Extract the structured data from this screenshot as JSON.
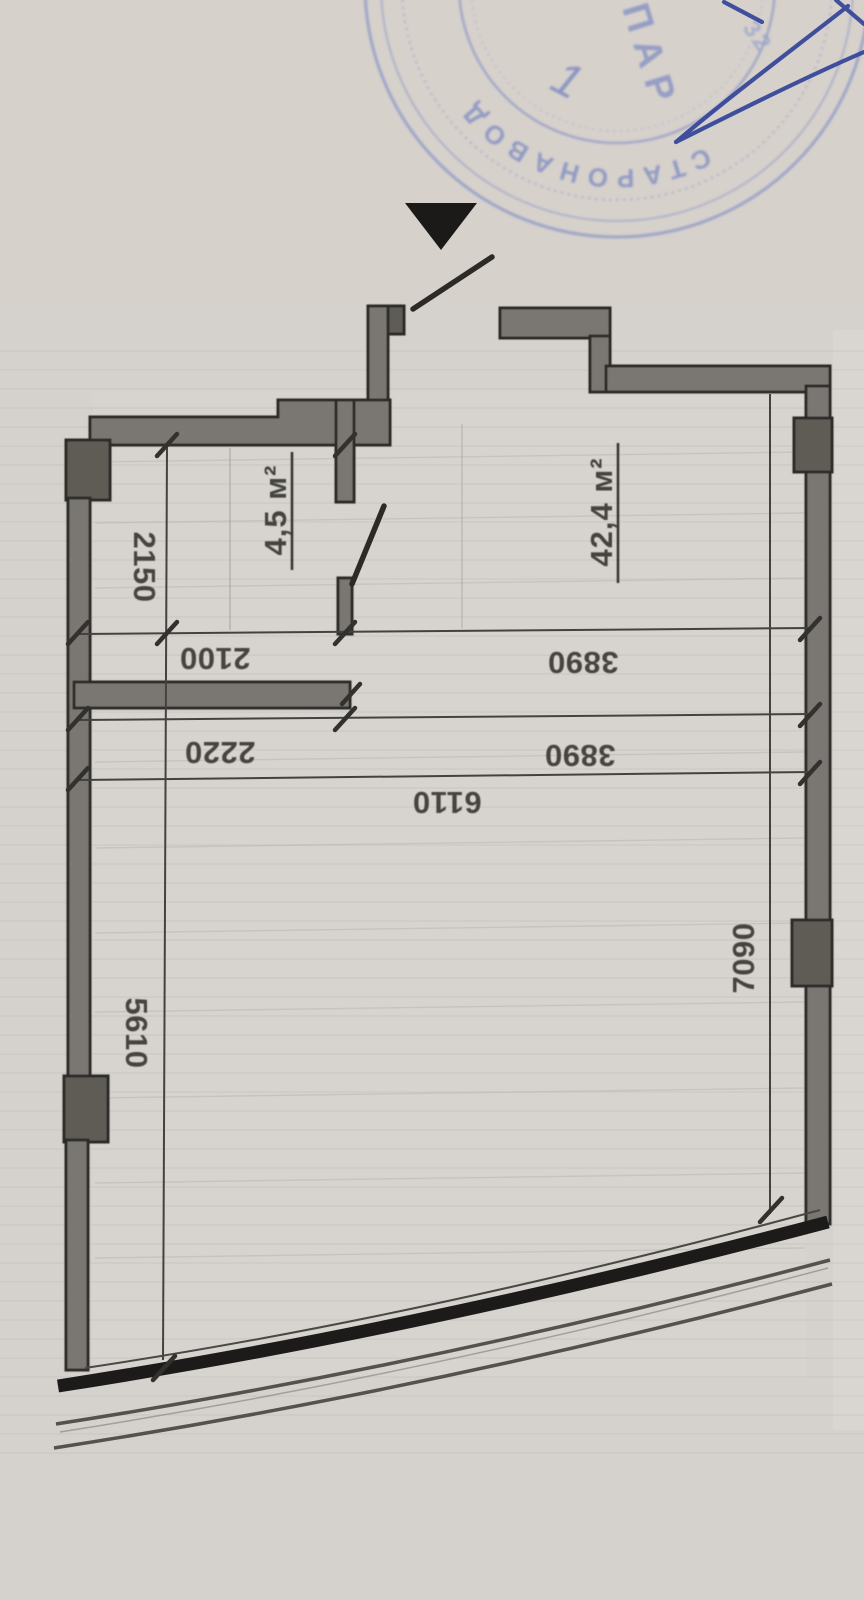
{
  "document": {
    "kind": "scanned apartment floor plan",
    "page_background": "#d5d1cc"
  },
  "stamp": {
    "arc_text": "СТАРОНАВОД",
    "center_text": "ПАР",
    "numeral": "1",
    "corner_fragment": "32",
    "ink_color": "#8591c2",
    "signature_color": "#2c3e96"
  },
  "rooms": [
    {
      "id": "small-room",
      "area_label": "4,5 м²"
    },
    {
      "id": "main-room",
      "area_label": "42,4 м²"
    }
  ],
  "dimensions": {
    "d2150": "2150",
    "d2100": "2100",
    "d2220": "2220",
    "d3890a": "3890",
    "d3890b": "3890",
    "d6110": "6110",
    "d5610": "5610",
    "d7090": "7090"
  },
  "colors": {
    "paper": "#d5d1cc",
    "wall_fill": "#7a7672",
    "wall_edge": "#2c2a27",
    "pillar_fill": "#5f5b57",
    "thin_line": "#44423f",
    "faint_line": "#a9a5a0",
    "curve_wall": "#1c1b1a",
    "dimension_text": "#3b3936",
    "stamp_ink": "#8591c2",
    "signature_ink": "#2c3e96"
  }
}
